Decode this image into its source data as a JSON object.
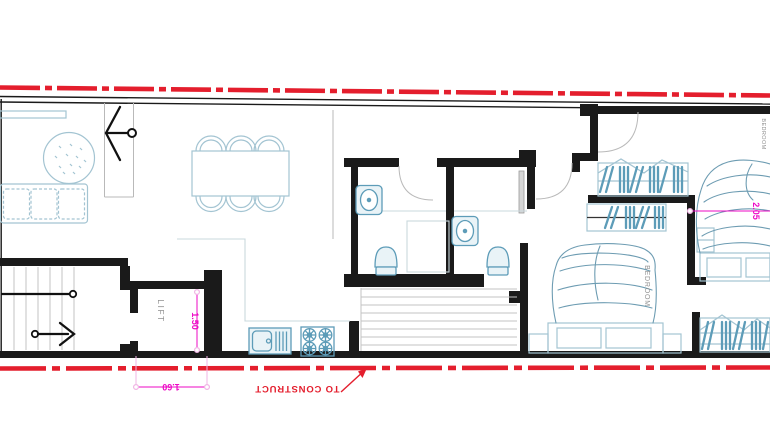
{
  "colors": {
    "wall": "#1a1a1a",
    "boundary_red": "#e41e2d",
    "dimension_magenta": "#ee0ac6",
    "extension_pink": "#f0b4e4",
    "fixture_cyan": "#5d9cb8",
    "furniture_cyan": "#a3c4d2",
    "counter_pale": "#c9d8dd",
    "blanket_blue": "#6d9cb2",
    "label_gray": "#8f8f8f",
    "step_gray": "#c3c3c3",
    "door_gray": "#b9b9b9",
    "background": "#ffffff"
  },
  "labels": {
    "lift": "LIFT",
    "bedroom_main": "BEDROOM",
    "bedroom_second": "BEDROOM",
    "to_construct": "TO CONSTRUCT"
  },
  "dimensions": {
    "lift_clear_width": "1.50",
    "lift_outer_width": "1.60",
    "bed_width": "2.05"
  }
}
